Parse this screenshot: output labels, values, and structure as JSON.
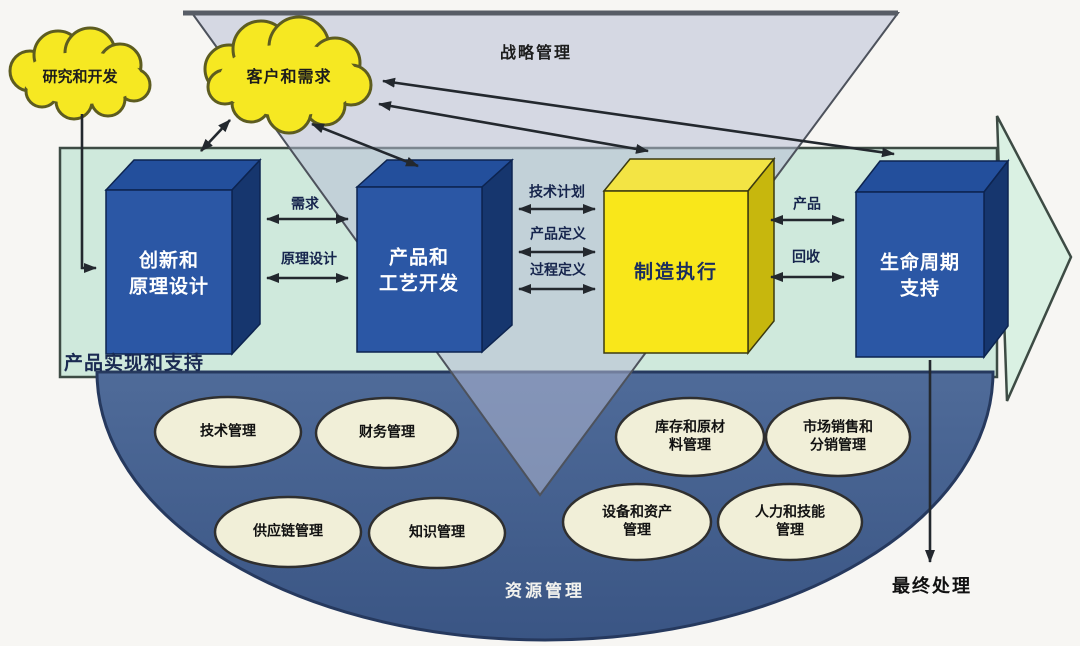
{
  "colors": {
    "cloud-fill": "#f6e822",
    "band-fill": "#cfe9dc",
    "band-head-fill": "#daf1e3",
    "dome-fill": "#44618f",
    "box-blue": "#2b57a5",
    "box-blue-top": "#234f9c",
    "box-blue-side": "#16366e",
    "box-yellow": "#f9e71a",
    "box-yellow-top": "#f3e444",
    "box-yellow-side": "#c7b70d",
    "pool-fill": "#f1efd8",
    "line-color": "#23282e",
    "triangle-fill": "rgba(182,188,212,0.52)"
  },
  "strategy": {
    "label": "战略管理"
  },
  "clouds": {
    "rd": {
      "label": "研究和开发"
    },
    "customer": {
      "label": "客户和需求"
    }
  },
  "band": {
    "label": "产品实现和支持"
  },
  "boxes": {
    "innovation": {
      "label": [
        "创新和",
        "原理设计"
      ]
    },
    "process": {
      "label": [
        "产品和",
        "工艺开发"
      ]
    },
    "manufacturing": {
      "label": [
        "制造执行"
      ]
    },
    "lifecycle": {
      "label": [
        "生命周期",
        "支持"
      ]
    }
  },
  "flows": {
    "demand": "需求",
    "principle": "原理设计",
    "techplan": "技术计划",
    "proddef": "产品定义",
    "procdef": "过程定义",
    "product": "产品",
    "recycle": "回收"
  },
  "resources": {
    "title": "资源管理",
    "pools": [
      {
        "label": [
          "技术管理"
        ]
      },
      {
        "label": [
          "财务管理"
        ]
      },
      {
        "label": [
          "库存和原材",
          "料管理"
        ]
      },
      {
        "label": [
          "市场销售和",
          "分销管理"
        ]
      },
      {
        "label": [
          "供应链管理"
        ]
      },
      {
        "label": [
          "知识管理"
        ]
      },
      {
        "label": [
          "设备和资产",
          "管理"
        ]
      },
      {
        "label": [
          "人力和技能",
          "管理"
        ]
      }
    ]
  },
  "disposal": {
    "label": "最终处理"
  }
}
